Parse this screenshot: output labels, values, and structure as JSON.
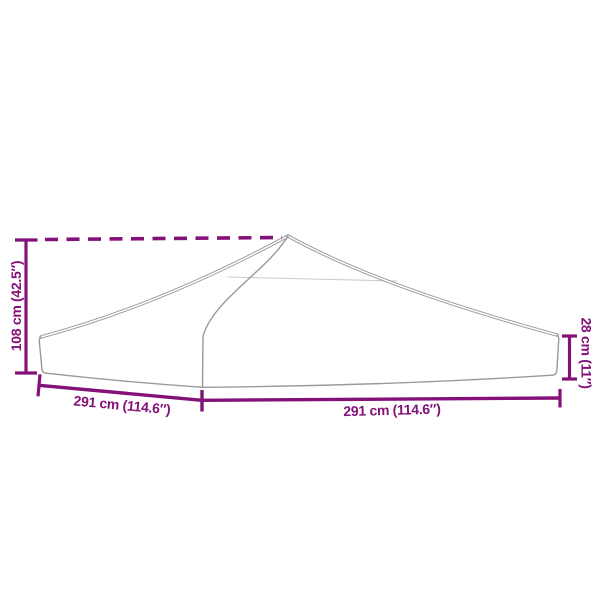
{
  "diagram": {
    "title": "Party tent roof canopy dimension diagram",
    "colors": {
      "accent": "#841178",
      "outline": "#9a9a9a",
      "outline_faint": "#cccccc",
      "background": "#ffffff"
    },
    "labels": {
      "total_height": "108 cm (42.5″)",
      "valance_height": "28 cm (11″)",
      "depth": "291 cm (114.6″)",
      "width": "291 cm (114.6″)"
    }
  }
}
